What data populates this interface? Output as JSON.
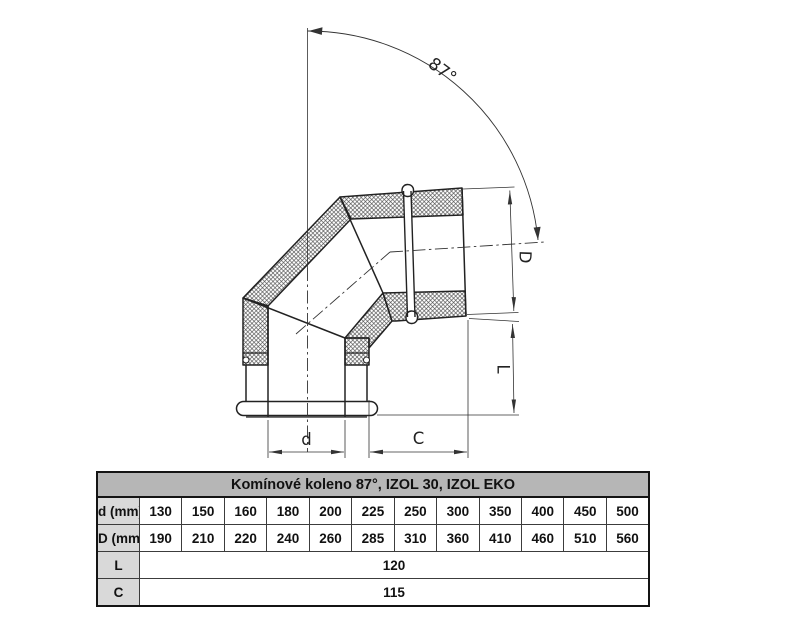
{
  "drawing": {
    "angle_label": "87°",
    "dim_outer_label": "D",
    "dim_length_label": "L",
    "dim_inner_label": "d",
    "dim_offset_label": "C"
  },
  "table": {
    "title": "Komínové koleno 87°, IZOL 30, IZOL EKO",
    "rows": [
      {
        "label": "d (mm) vnitřní průměr:",
        "values": [
          "130",
          "150",
          "160",
          "180",
          "200",
          "225",
          "250",
          "300",
          "350",
          "400",
          "450",
          "500"
        ]
      },
      {
        "label": "D (mm) vnější průměr:",
        "values": [
          "190",
          "210",
          "220",
          "240",
          "260",
          "285",
          "310",
          "360",
          "410",
          "460",
          "510",
          "560"
        ]
      },
      {
        "label": "L",
        "value": "120"
      },
      {
        "label": "C",
        "value": "115"
      }
    ]
  },
  "colors": {
    "title_bg": "#b6b6b6",
    "label_bg": "#d9d9d9",
    "line": "#222222"
  }
}
